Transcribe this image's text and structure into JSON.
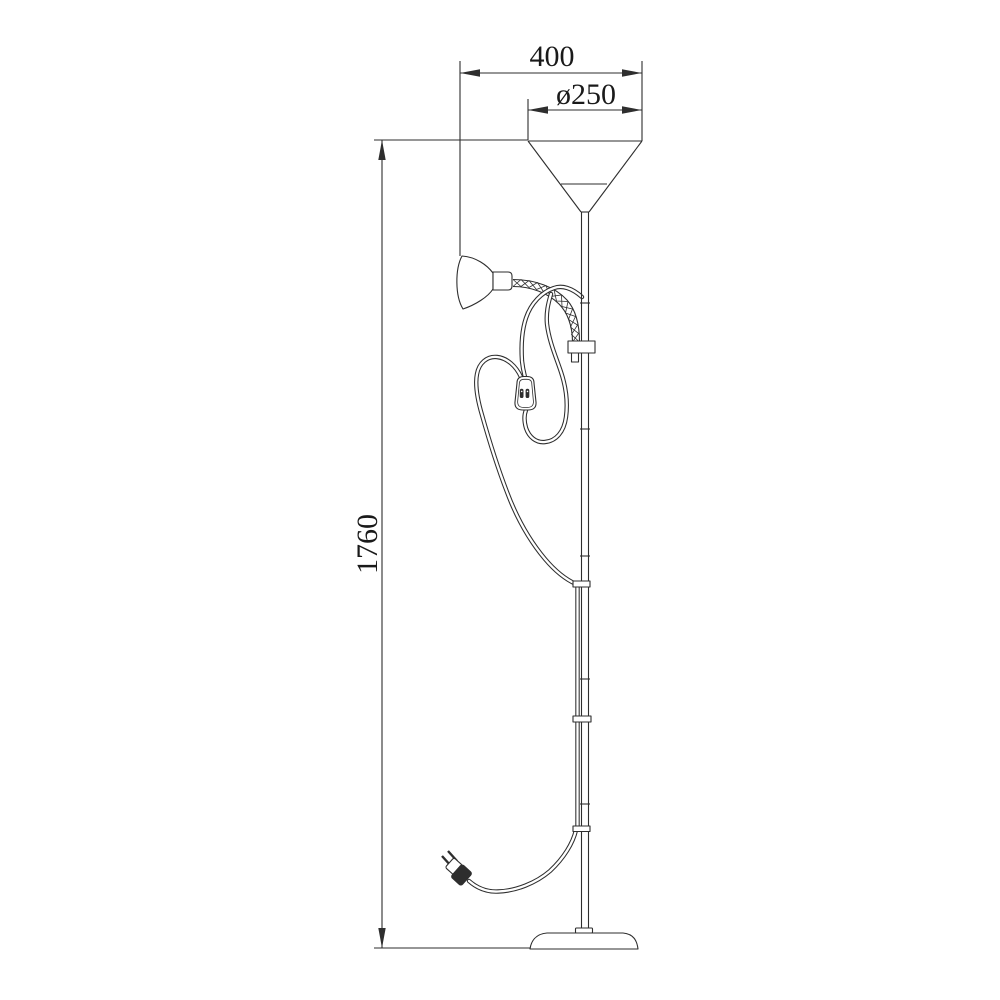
{
  "dimensions": {
    "width": {
      "label": "400"
    },
    "diameter": {
      "label": "ø250"
    },
    "height": {
      "label": "1760"
    }
  },
  "colors": {
    "line": "#2e2e2e",
    "text": "#1a1a1a",
    "background": "#ffffff"
  }
}
